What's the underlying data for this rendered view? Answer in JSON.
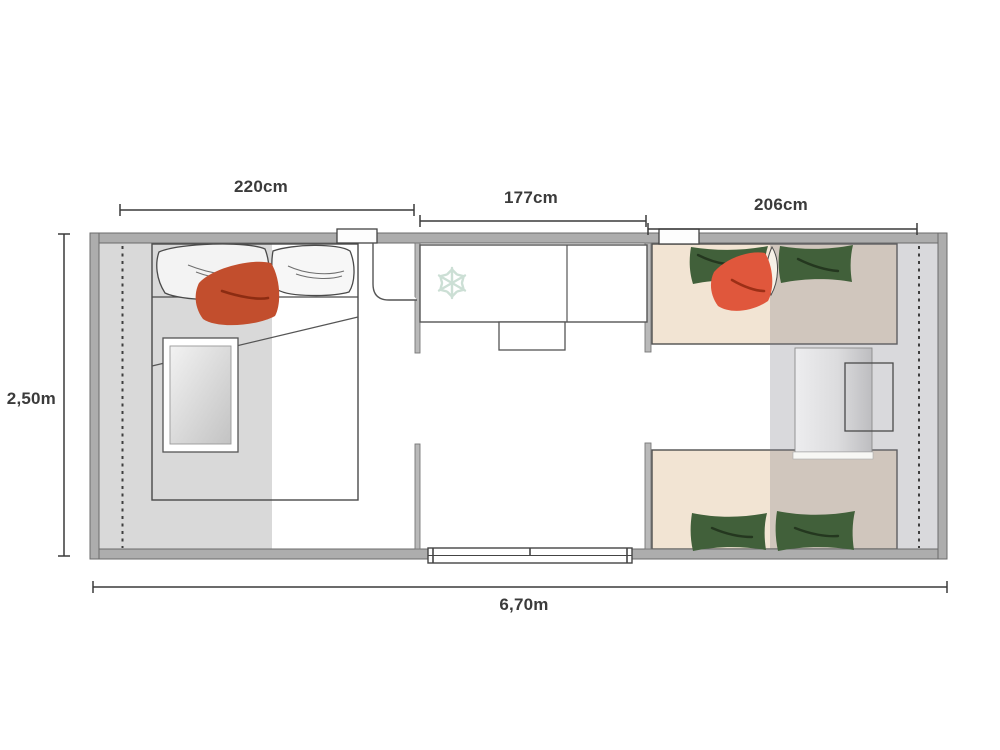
{
  "plan": {
    "labels": {
      "left_room_width": "220cm",
      "middle_room_width": "177cm",
      "right_room_width": "206cm",
      "depth": "2,50m",
      "total_width": "6,70m"
    }
  },
  "colors": {
    "wall": "#adadad",
    "overlay_left": "#d9d9d9",
    "overlay_right": "rgba(130,128,138,0.30)",
    "bed_tan": "#f2e4d3",
    "pillow_green": "#41603a",
    "pillow_red_left": "#c24e2d",
    "pillow_orange_right": "#e0573c",
    "pillow_white_lens": "#f6f1e7",
    "snowflake": "#ccdfd5",
    "dimension_text": "#3b3b3b"
  },
  "icons": {
    "fridge": "snowflake-icon"
  }
}
